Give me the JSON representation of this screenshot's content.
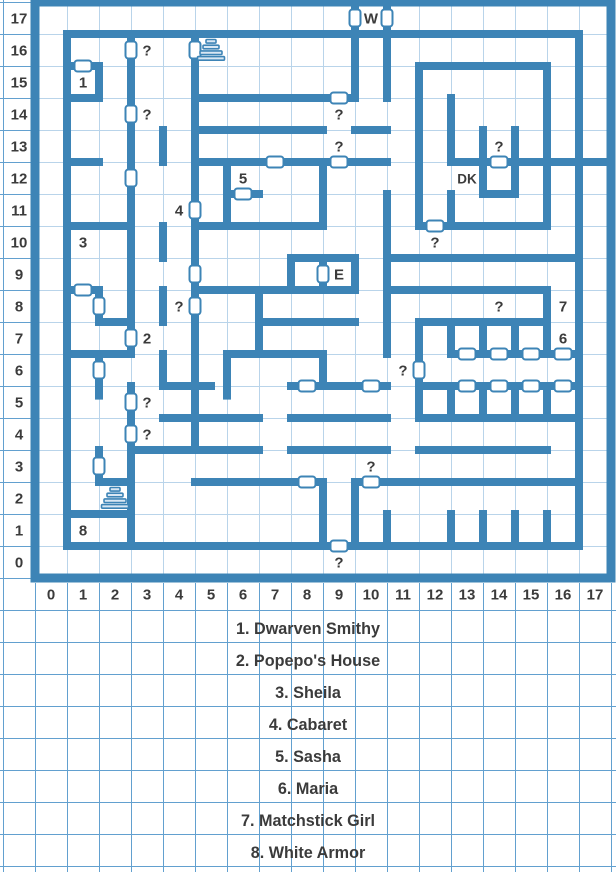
{
  "page": {
    "title": "Town map with legend"
  },
  "map": {
    "cols": 18,
    "rows": 18,
    "cell": 32,
    "origin": {
      "x": 35,
      "y": 2
    },
    "colors": {
      "wall": "#3d84b6",
      "grid_inner": "#b9d4ea",
      "grid_outer": "#62a0cf",
      "background": "#ffffff",
      "door_fill": "#ffffff",
      "text": "#3b3b3b",
      "stairs_fill": "#d9e7f3"
    },
    "x_axis": [
      "0",
      "1",
      "2",
      "3",
      "4",
      "5",
      "6",
      "7",
      "8",
      "9",
      "10",
      "11",
      "12",
      "13",
      "14",
      "15",
      "16",
      "17"
    ],
    "y_axis": [
      "17",
      "16",
      "15",
      "14",
      "13",
      "12",
      "11",
      "10",
      "9",
      "8",
      "7",
      "6",
      "5",
      "4",
      "3",
      "2",
      "1",
      "0"
    ],
    "walls": {
      "horizontal": [
        [
          0,
          0,
          18
        ],
        [
          1,
          1,
          17
        ],
        [
          2,
          1,
          2
        ],
        [
          2,
          12,
          16
        ],
        [
          3,
          1,
          2
        ],
        [
          3,
          5,
          10
        ],
        [
          4,
          5,
          9
        ],
        [
          4,
          10,
          11
        ],
        [
          5,
          1,
          2
        ],
        [
          5,
          5,
          11
        ],
        [
          5,
          13,
          18
        ],
        [
          6,
          6,
          7
        ],
        [
          6,
          14,
          15
        ],
        [
          7,
          1,
          3
        ],
        [
          7,
          5,
          9
        ],
        [
          7,
          12,
          16
        ],
        [
          8,
          8,
          10
        ],
        [
          8,
          11,
          17
        ],
        [
          9,
          1,
          2
        ],
        [
          9,
          5,
          10
        ],
        [
          9,
          11,
          16
        ],
        [
          10,
          2,
          3
        ],
        [
          10,
          7,
          10
        ],
        [
          10,
          12,
          16
        ],
        [
          11,
          1,
          3
        ],
        [
          11,
          6,
          9
        ],
        [
          11,
          13,
          17
        ],
        [
          12,
          4,
          5.5
        ],
        [
          12,
          8,
          11
        ],
        [
          12,
          12,
          17
        ],
        [
          13,
          4,
          7
        ],
        [
          13,
          8,
          11
        ],
        [
          13,
          12,
          17
        ],
        [
          14,
          3,
          7
        ],
        [
          14,
          8,
          11
        ],
        [
          14,
          12,
          16
        ],
        [
          15,
          2,
          3
        ],
        [
          15,
          5,
          9
        ],
        [
          15,
          10,
          17
        ],
        [
          16,
          1,
          3
        ],
        [
          17,
          1,
          17
        ],
        [
          18,
          0,
          18
        ]
      ],
      "vertical": [
        [
          0,
          0,
          18
        ],
        [
          1,
          1,
          17
        ],
        [
          2,
          2,
          3
        ],
        [
          2,
          9,
          10
        ],
        [
          2,
          11,
          12.3
        ],
        [
          2,
          14,
          15
        ],
        [
          3,
          1,
          11
        ],
        [
          3,
          12,
          17
        ],
        [
          4,
          4,
          5
        ],
        [
          4,
          7,
          8
        ],
        [
          4,
          9,
          10
        ],
        [
          4,
          11,
          12
        ],
        [
          5,
          1,
          14
        ],
        [
          6,
          5,
          7
        ],
        [
          6,
          11,
          12.3
        ],
        [
          7,
          9,
          11
        ],
        [
          8,
          8,
          9
        ],
        [
          9,
          5,
          7
        ],
        [
          9,
          8,
          9
        ],
        [
          9,
          11,
          12
        ],
        [
          9,
          15,
          17
        ],
        [
          10,
          0,
          3
        ],
        [
          10,
          8,
          9
        ],
        [
          10,
          15,
          17
        ],
        [
          11,
          0,
          3
        ],
        [
          11,
          6,
          11
        ],
        [
          11,
          16,
          17
        ],
        [
          12,
          2,
          7
        ],
        [
          12,
          10,
          13
        ],
        [
          13,
          3,
          5
        ],
        [
          13,
          6,
          7
        ],
        [
          13,
          10,
          11
        ],
        [
          13,
          12,
          13
        ],
        [
          13,
          16,
          17
        ],
        [
          14,
          4,
          6
        ],
        [
          14,
          10,
          11
        ],
        [
          14,
          12,
          13
        ],
        [
          14,
          16,
          17
        ],
        [
          15,
          4,
          6
        ],
        [
          15,
          10,
          11
        ],
        [
          15,
          12,
          13
        ],
        [
          15,
          16,
          17
        ],
        [
          16,
          2,
          7
        ],
        [
          16,
          9,
          11
        ],
        [
          16,
          12,
          13
        ],
        [
          16,
          16,
          17
        ],
        [
          17,
          1,
          17
        ],
        [
          18,
          0,
          18
        ]
      ]
    },
    "doors": {
      "horizontal": [
        [
          2,
          1.5
        ],
        [
          3,
          9.5
        ],
        [
          5,
          7.5
        ],
        [
          5,
          9.5
        ],
        [
          5,
          14.5
        ],
        [
          6,
          6.5
        ],
        [
          7,
          12.5
        ],
        [
          9,
          1.5
        ],
        [
          11,
          13.5
        ],
        [
          11,
          14.5
        ],
        [
          11,
          15.5
        ],
        [
          11,
          16.5
        ],
        [
          12,
          8.5
        ],
        [
          12,
          10.5
        ],
        [
          12,
          13.5
        ],
        [
          12,
          14.5
        ],
        [
          12,
          15.5
        ],
        [
          12,
          16.5
        ],
        [
          15,
          8.5
        ],
        [
          15,
          10.5
        ],
        [
          17,
          9.5
        ]
      ],
      "vertical": [
        [
          10,
          0.5
        ],
        [
          11,
          0.5
        ],
        [
          3,
          1.5
        ],
        [
          5,
          1.5
        ],
        [
          3,
          3.5
        ],
        [
          3,
          5.5
        ],
        [
          5,
          6.5
        ],
        [
          5,
          8.5
        ],
        [
          5,
          9.5
        ],
        [
          2,
          9.5
        ],
        [
          9,
          8.5
        ],
        [
          3,
          10.5
        ],
        [
          2,
          11.5
        ],
        [
          12,
          11.5
        ],
        [
          3,
          12.5
        ],
        [
          3,
          13.5
        ],
        [
          2,
          14.5
        ]
      ]
    },
    "location_labels": [
      {
        "text": "W",
        "col": 10,
        "row": 17
      },
      {
        "text": "1",
        "col": 1,
        "row": 15
      },
      {
        "text": "3",
        "col": 1,
        "row": 10
      },
      {
        "text": "4",
        "col": 4,
        "row": 11
      },
      {
        "text": "5",
        "col": 6,
        "row": 12
      },
      {
        "text": "DK",
        "col": 13,
        "row": 12
      },
      {
        "text": "E",
        "col": 9,
        "row": 9
      },
      {
        "text": "7",
        "col": 16,
        "row": 8
      },
      {
        "text": "2",
        "col": 3,
        "row": 7
      },
      {
        "text": "6",
        "col": 16,
        "row": 7
      },
      {
        "text": "8",
        "col": 1,
        "row": 1
      }
    ],
    "question_marks": [
      [
        3,
        16
      ],
      [
        3,
        14
      ],
      [
        9,
        14
      ],
      [
        9,
        13
      ],
      [
        14,
        13
      ],
      [
        12,
        10
      ],
      [
        4,
        8
      ],
      [
        14,
        8
      ],
      [
        11,
        6
      ],
      [
        3,
        5
      ],
      [
        3,
        4
      ],
      [
        10,
        3
      ],
      [
        9,
        0
      ]
    ],
    "stairs": [
      [
        5,
        16
      ],
      [
        2,
        2
      ]
    ]
  },
  "legend": {
    "items": [
      "1. Dwarven Smithy",
      "2. Popepo's House",
      "3. Sheila",
      "4. Cabaret",
      "5. Sasha",
      "6. Maria",
      "7. Matchstick Girl",
      "8. White Armor"
    ]
  }
}
